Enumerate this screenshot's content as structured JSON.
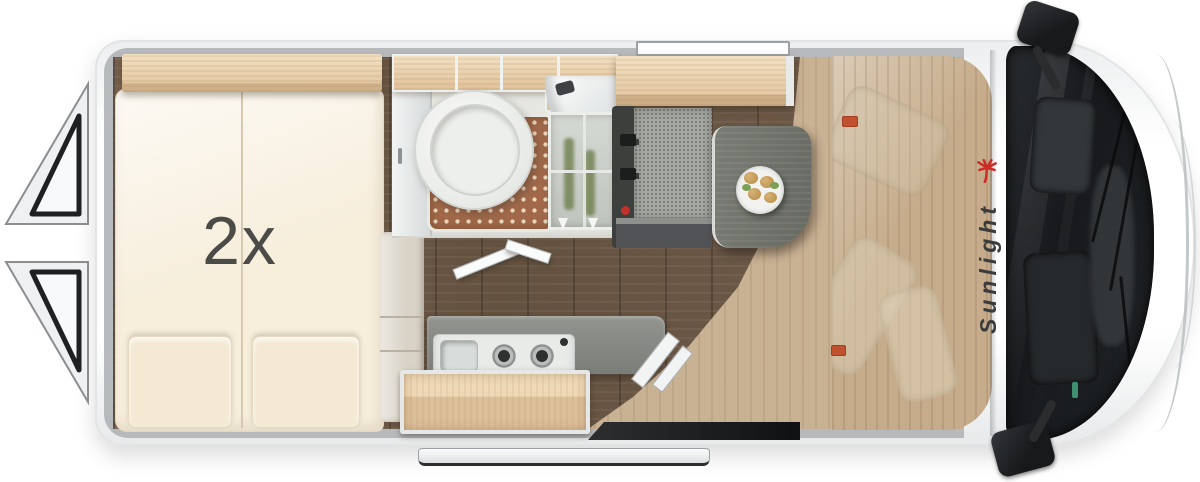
{
  "floorplan": {
    "bed_capacity_label": "2x",
    "brand": "Sunlight"
  },
  "colors": {
    "background": "#ffffff",
    "wall_lining": "#b7babc",
    "mattress": "#f7eedc",
    "wood_light": "#e9d0ab",
    "floor_dark": "#6d5949",
    "floor_entry": "#c9b193",
    "shower_mat": "#a1694a",
    "counter": "#868983",
    "table": "#70736c",
    "bench": "#a6a8a3",
    "windshield": "#17191c",
    "accent_red": "#c23127",
    "label_text": "#4b4b48",
    "logo_text": "#3b3b3b",
    "logo_palm": "#cf2b26"
  }
}
